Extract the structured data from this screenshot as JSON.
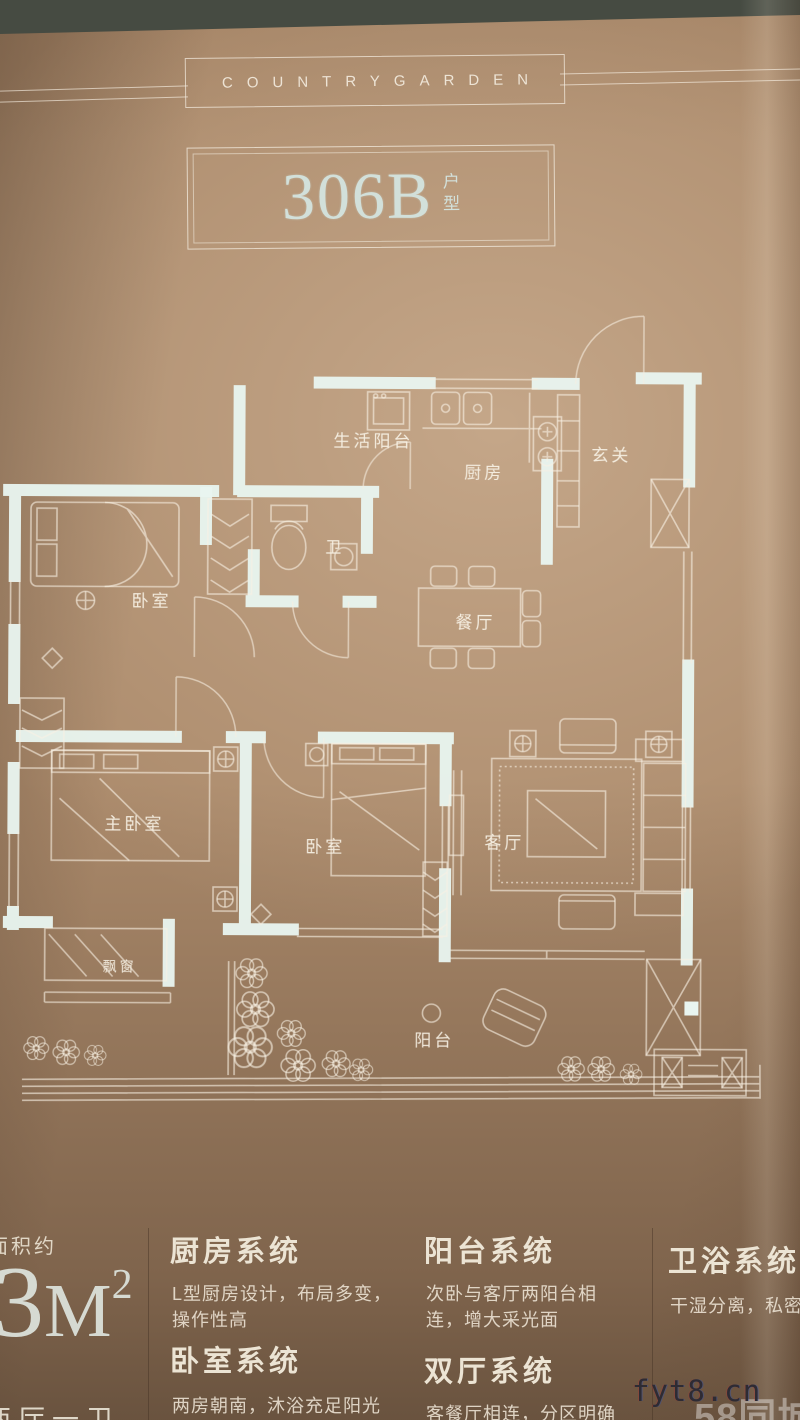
{
  "brand": {
    "name": "COUNTRYGARDEN"
  },
  "title": {
    "code": "306B",
    "type_chars": [
      "户",
      "型"
    ]
  },
  "floor_plan": {
    "rooms": [
      {
        "label": "生活阳台"
      },
      {
        "label": "厨房"
      },
      {
        "label": "玄关"
      },
      {
        "label": "卫"
      },
      {
        "label": "卧室"
      },
      {
        "label": "餐厅"
      },
      {
        "label": "主卧室"
      },
      {
        "label": "卧室"
      },
      {
        "label": "客厅"
      },
      {
        "label": "飘窗"
      },
      {
        "label": "阳台"
      }
    ]
  },
  "area": {
    "label": "面积约",
    "value_digit_partial": "8",
    "value_digit": "3",
    "value_unit": "M",
    "value_sup": "2",
    "layout_partial": "两厅一卫"
  },
  "systems": [
    {
      "title": "厨房系统",
      "lines": [
        "L型厨房设计，布局多变，",
        "操作性高"
      ]
    },
    {
      "title": "卧室系统",
      "lines": [
        "两房朝南，沐浴充足阳光"
      ]
    },
    {
      "title": "阳台系统",
      "lines": [
        "次卧与客厅两阳台相",
        "连，增大采光面"
      ]
    },
    {
      "title": "双厅系统",
      "lines": [
        "客餐厅相连，分区明确"
      ]
    },
    {
      "title": "卫浴系统",
      "lines": [
        "干湿分离，私密性强"
      ]
    }
  ],
  "watermarks": {
    "site": "fyt8.cn",
    "portal": "58同城"
  },
  "colors": {
    "wall": "#e9f5f0",
    "line": "#f6eee1",
    "band": "#464b42",
    "title_text": "#d2e0da"
  }
}
